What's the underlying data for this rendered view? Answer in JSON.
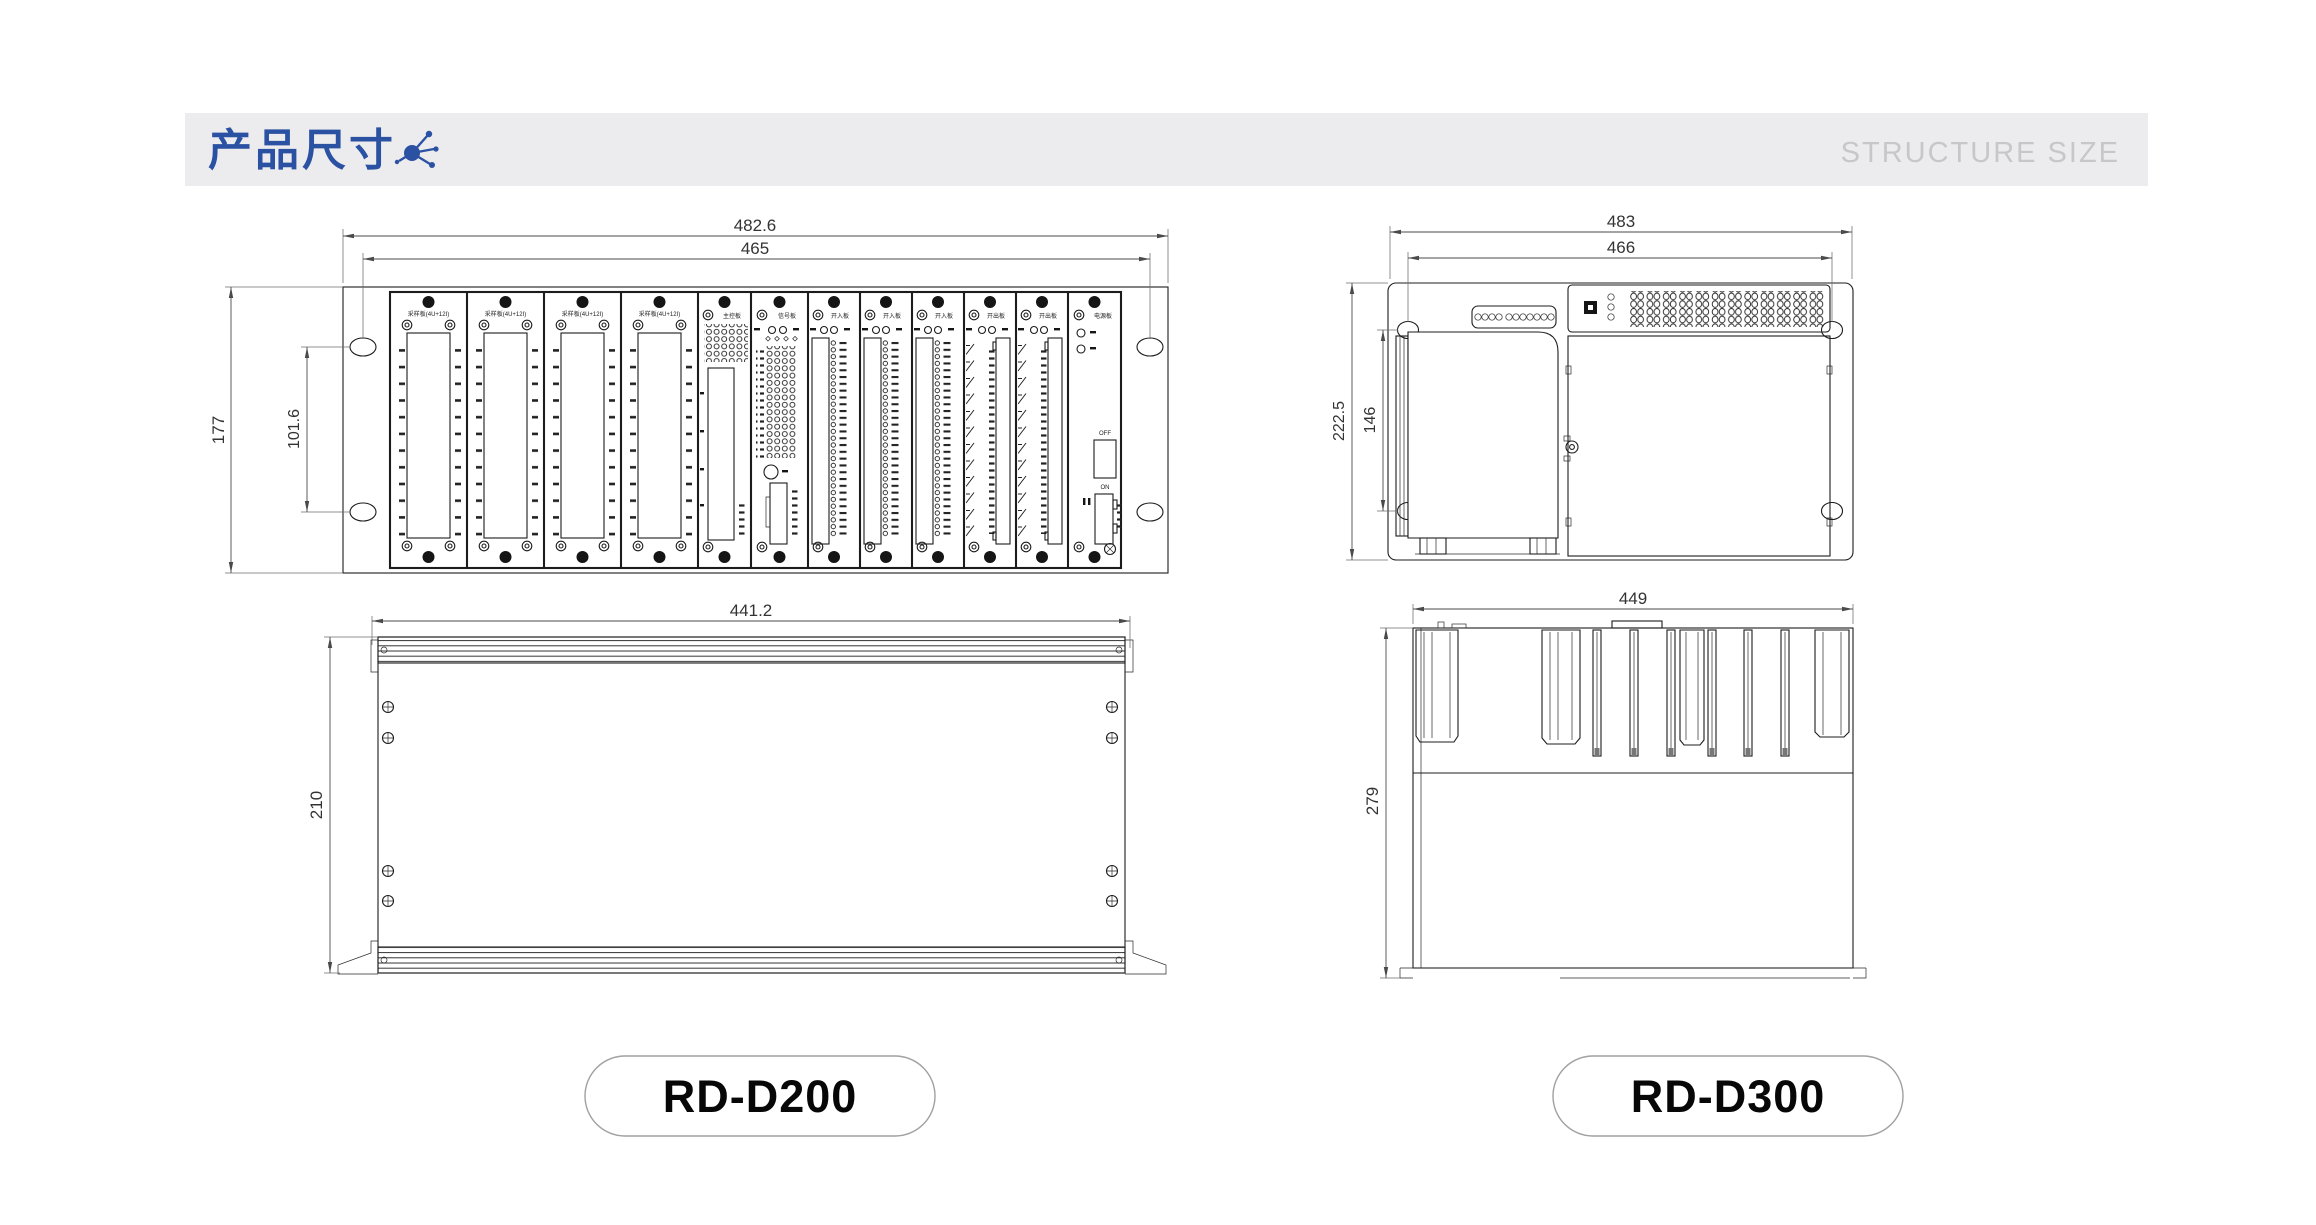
{
  "header": {
    "title": "产品尺寸",
    "subtitle": "STRUCTURE SIZE",
    "accent_color": "#2b51a3",
    "band_color": "#ececee",
    "subtitle_color": "#c7c7ca"
  },
  "d200": {
    "name": "RD-D200",
    "front": {
      "dim_overall_width": "482.6",
      "dim_hole_span": "465",
      "dim_height": "177",
      "dim_hole_pitch": "101.6",
      "card_labels": {
        "sampler": "采样板(4U+12I)",
        "main": "主控板",
        "signal": "信号板",
        "digital_in": "开入板",
        "digital_out": "开出板",
        "power": "电源板"
      },
      "power_switch": {
        "off": "OFF",
        "on": "ON"
      }
    },
    "bottom": {
      "dim_width": "441.2",
      "dim_depth": "210"
    }
  },
  "d300": {
    "name": "RD-D300",
    "front": {
      "dim_overall_width": "483",
      "dim_hole_span": "466",
      "dim_height": "222.5",
      "dim_hole_pitch": "146"
    },
    "side": {
      "dim_width": "449",
      "dim_depth": "279"
    }
  }
}
